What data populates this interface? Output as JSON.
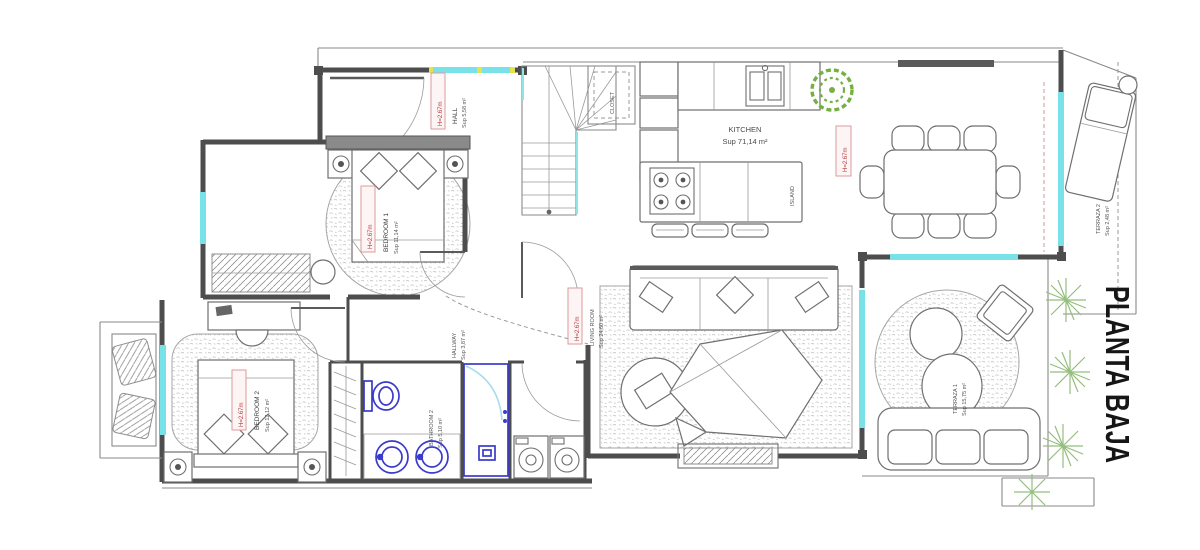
{
  "plan": {
    "title": "PLANTA BAJA",
    "labels": {
      "hall": {
        "name": "HALL",
        "area": "Sup 5,58 m²",
        "height": "H=2.67m"
      },
      "bedroom1": {
        "name": "BEDROOM 1",
        "area": "Sup 11,14 m²",
        "height": "H=2.67m"
      },
      "bedroom2": {
        "name": "BEDROOM 2",
        "area": "Sup 12,12 m²",
        "height": "H=2.67m"
      },
      "hallway": {
        "name": "HALLWAY",
        "area": "Sup 3,87 m²"
      },
      "bathroom2": {
        "name": "BATHROOM 2",
        "area": "Sup 5,10 m²"
      },
      "kitchen": {
        "name": "KITCHEN",
        "area": "Sup 71,14 m²",
        "height": "H=2.67m"
      },
      "living": {
        "name": "LIVING ROOM",
        "area": "Sup 24,60 m²",
        "height": "H=2.67m"
      },
      "closet": {
        "name": "CLOSET"
      },
      "island": {
        "name": "ISLAND"
      },
      "terraza1": {
        "name": "TERRAZA 1",
        "area": "Sup 15,75 m²"
      },
      "terraza2": {
        "name": "TERRAZA 2",
        "area": "Sup 2,48 m²"
      }
    },
    "colors": {
      "wall": "#4d4d4d",
      "line": "#8a8a8a",
      "window": "#79e2e8",
      "accent_yellow": "#e3e34f",
      "red_label": "#b23b3b",
      "red_box": "#dd9a9a",
      "fixture_blue": "#3a3acc",
      "glass": "#a8dbec",
      "plant_green": "#76b043",
      "foliage": "#95bd7d"
    }
  }
}
